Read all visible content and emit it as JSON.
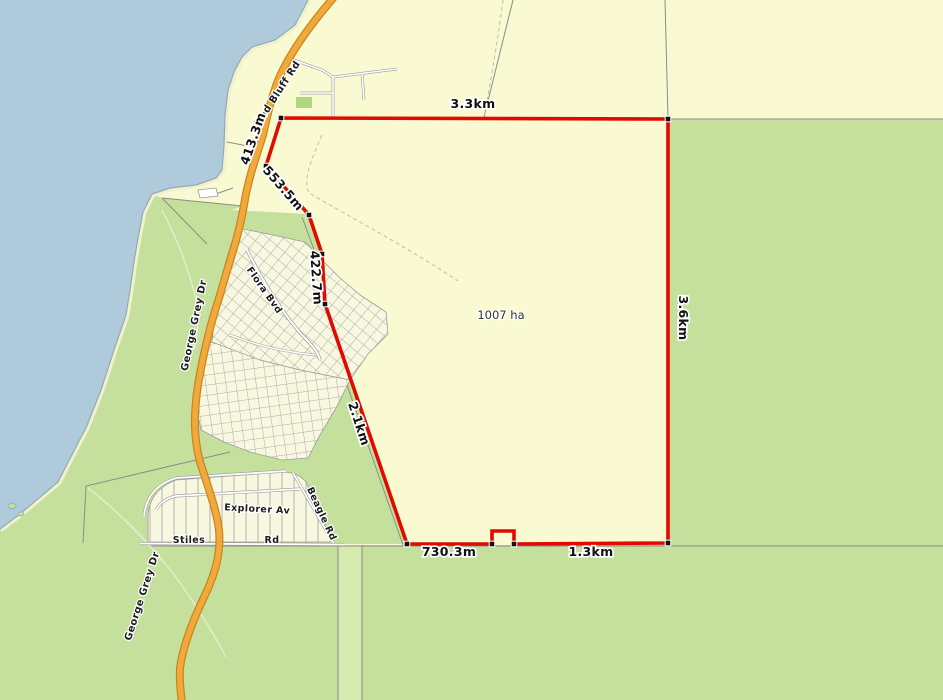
{
  "map": {
    "area_label": "1007 ha",
    "measurements": {
      "top_edge": "3.3km",
      "right_edge": "3.6km",
      "nw_segment_1": "413.3m",
      "nw_segment_2": "553.5m",
      "west_segment": "422.7m",
      "sw_diagonal": "2.1km",
      "bottom_left": "730.3m",
      "bottom_right": "1.3km"
    },
    "road_labels": {
      "red_bluff_rd": "Red Bluff Rd",
      "george_grey_dr_upper": "George Grey Dr",
      "george_grey_dr_lower": "George Grey Dr",
      "flora_bvd": "Flora Bvd",
      "explorer_av": "Explorer Av",
      "stiles": "Stiles",
      "stiles_rd_suffix": "Rd",
      "beagle_rd": "Beagle Rd"
    },
    "colors": {
      "water": "#AFCBDB",
      "land": "#FAFAD2",
      "rural_green": "#C5E09C",
      "road_reserve_green": "#D6EAB0",
      "park_green": "#AED77F",
      "highway_orange": "#F2A93B",
      "highway_casing": "#C8861E",
      "parcel_red": "#E00A00",
      "cadastral_gray": "#8C8C8C"
    }
  }
}
